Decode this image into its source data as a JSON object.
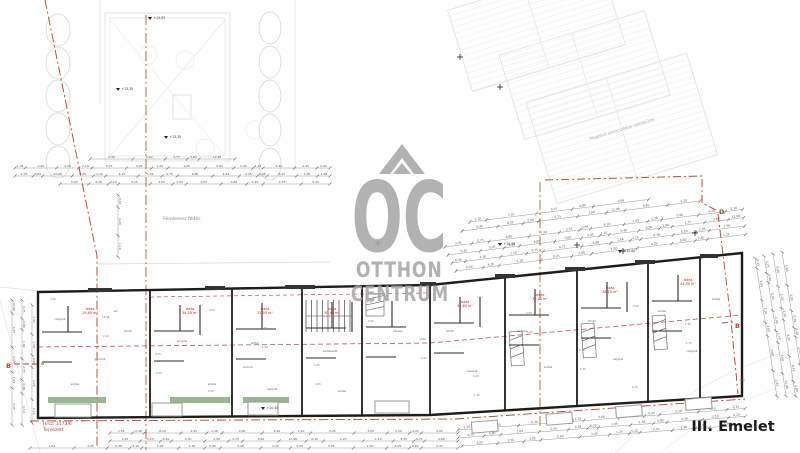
{
  "floor_label": "III. Emelet",
  "watermark": {
    "oc": "OC",
    "line1": "OTTHON",
    "line2": "CENTRUM",
    "color": "#a5a5a5"
  },
  "site": {
    "neighbor_label": "Meglévő szomszédos lakóépület",
    "canopy_label": "Fémlemez fedés",
    "lot_label_line1": "Hrsz: 3173/6",
    "lot_label_line2": "Tervezett",
    "boundary_color": "#b03a2e"
  },
  "section_markers": {
    "b_left": "B",
    "b_right": "B",
    "d_right": "D"
  },
  "elevations": [
    {
      "label": "+14,05"
    },
    {
      "label": "+13,35"
    },
    {
      "label": "+13,35"
    },
    {
      "label": "+10,60"
    },
    {
      "label": "+10,45"
    },
    {
      "label": "+10,45"
    }
  ],
  "units": [
    {
      "name": "lakás",
      "area": "29,85 m²"
    },
    {
      "name": "lakás",
      "area": "34,20 m²"
    },
    {
      "name": "lakás",
      "area": "31,05 m²"
    },
    {
      "name": "lakás",
      "area": "30,45 m²"
    },
    {
      "name": "lakás",
      "area": "42,60 m²"
    },
    {
      "name": "lakás",
      "area": "38,15 m²"
    },
    {
      "name": "lakás",
      "area": "38,15 m²"
    },
    {
      "name": "lakás",
      "area": "44,90 m²"
    }
  ],
  "rooms": [
    "nappali",
    "szoba",
    "fürdő",
    "konyha",
    "előtér",
    "wc",
    "terasz",
    "közlekedő",
    "gardrób",
    "kamra"
  ],
  "dimensions": {
    "numbers": [
      "1,38",
      "0,90",
      "4,26",
      "2,10",
      "0,25",
      "3,05",
      "1,50",
      "4,05",
      "0,60",
      "2,45",
      "1,25",
      "5,40",
      "0,30",
      "2,90",
      "1,75",
      "3,60",
      "12,98",
      "0,45",
      "2,20",
      "1,10",
      "3,35",
      "0,75",
      "4,80",
      "1,64",
      "2,55",
      "0,38",
      "6,10",
      "1,95"
    ],
    "color": "#555555"
  },
  "colors": {
    "walls": "#1d1d1d",
    "red_line": "#c0392b",
    "red_text": "#cc2222",
    "balcony_green": "#86a97c",
    "faint": "#dedede",
    "chain": "#8a8a8a"
  }
}
